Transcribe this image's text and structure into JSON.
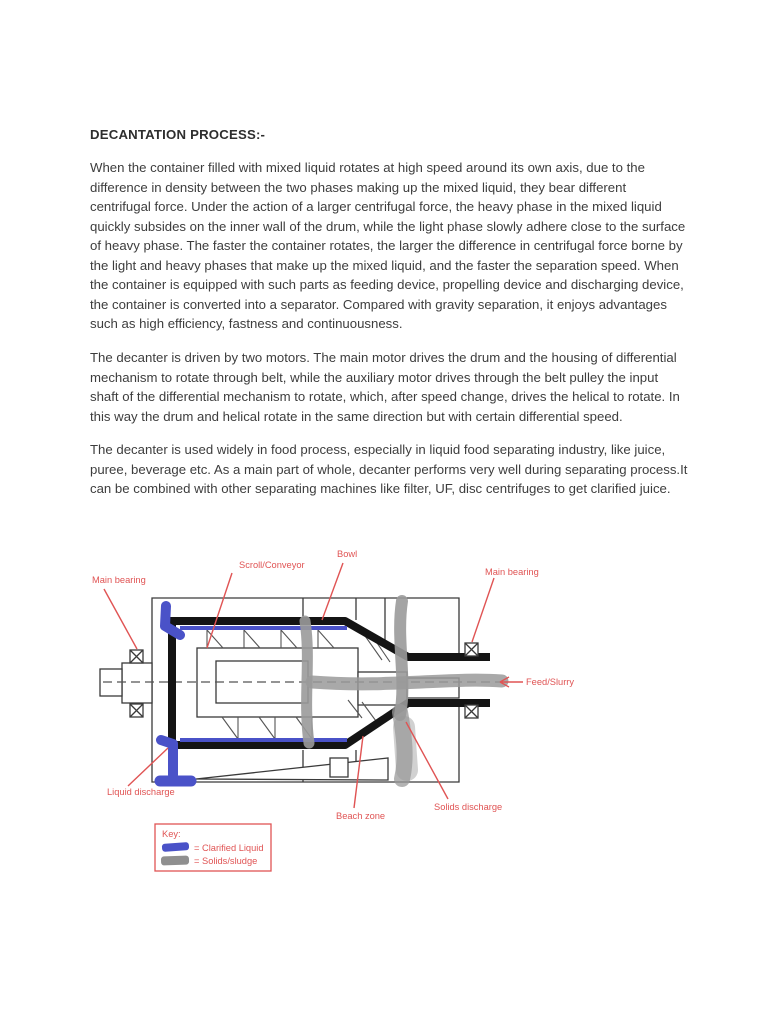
{
  "page": {
    "title": "DECANTATION PROCESS:-",
    "paragraphs": [
      "When the container filled with mixed liquid rotates at high speed around its own axis, due to the difference in density between the two phases making up the mixed liquid, they bear different centrifugal force. Under the action of a larger centrifugal force, the heavy phase in the mixed liquid quickly subsides on the inner wall of the drum, while the light phase slowly adhere close to the surface of heavy phase. The faster the container rotates, the larger the difference in centrifugal force borne by the light and heavy phases that make up the mixed liquid, and the faster the separation speed. When the container is equipped with such parts as feeding device, propelling device and discharging device, the container is converted into a separator. Compared with gravity separation, it enjoys advantages such as high efficiency, fastness and continuousness.",
      "The decanter is driven by two motors. The main motor drives the drum and the housing of differential mechanism to rotate through belt, while the auxiliary motor drives through the belt pulley the input shaft of the differential mechanism to rotate, which, after speed change, drives the helical to rotate. In this way the drum and helical rotate in the same direction but with certain differential speed.",
      "The decanter is used widely in food process, especially in liquid food separating industry, like juice, puree, beverage etc. As a main part of whole, decanter performs very well during separating process.It can be combined with other separating machines like filter, UF, disc centrifuges to get clarified juice."
    ]
  },
  "diagram": {
    "labels": {
      "main_bearing_left": "Main bearing",
      "scroll_conveyor": "Scroll/Conveyor",
      "bowl": "Bowl",
      "main_bearing_right": "Main bearing",
      "feed_slurry": "Feed/Slurry",
      "liquid_discharge": "Liquid discharge",
      "beach_zone": "Beach zone",
      "solids_discharge": "Solids discharge"
    },
    "key": {
      "title": "Key:",
      "items": [
        {
          "name": "clarified-liquid",
          "color": "#4a52c8",
          "label": "= Clarified Liquid"
        },
        {
          "name": "solids-sludge",
          "color": "#8f8f8f",
          "label": "= Solids/sludge"
        }
      ]
    },
    "colors": {
      "label_red": "#e05454",
      "liquid_blue": "#4a52c8",
      "solids_gray": "#9a9a9a",
      "outline_black": "#141414"
    }
  }
}
